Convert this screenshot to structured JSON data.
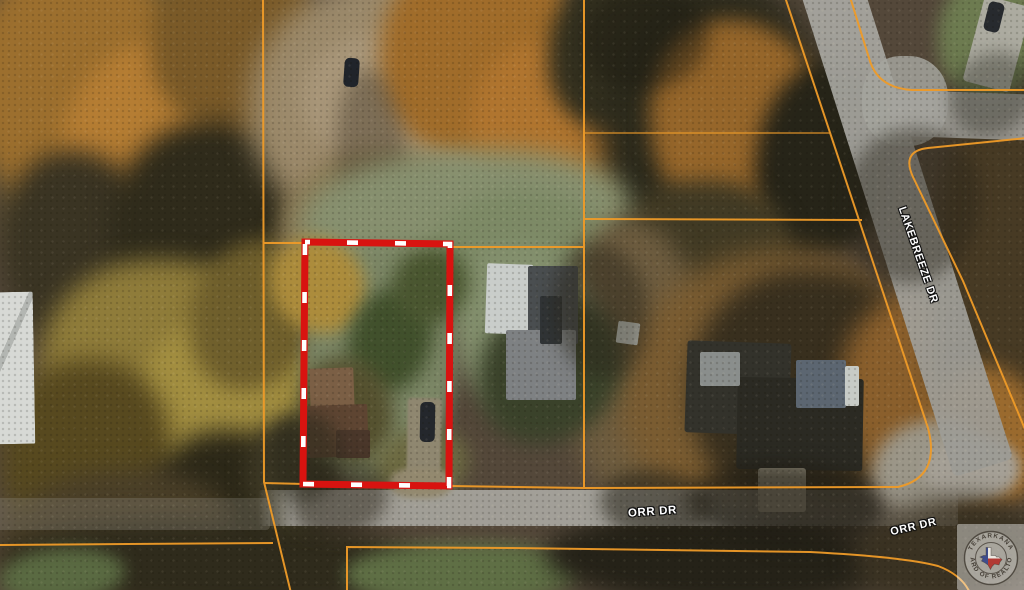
{
  "labels": {
    "lakebreeze": "LAKEBREEZE DR",
    "orr_main": "ORR DR",
    "orr_right": "ORR DR"
  },
  "colors": {
    "subject_parcel_outline": "#d81310",
    "subject_parcel_dash": "#ffffff",
    "parcel_boundary": "#ef9b28"
  },
  "watermark": {
    "arc_top": "TEXARKANA",
    "arc_bottom": "BOARD OF REALTORS"
  }
}
